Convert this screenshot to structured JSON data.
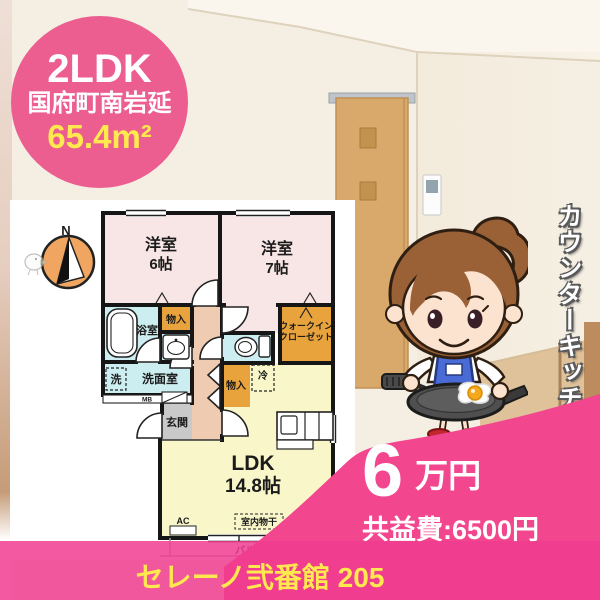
{
  "colors": {
    "badge_pink": "#ec5d90",
    "accent_pink": "#f2468e",
    "bar_pink": "#f0509b",
    "highlight_yellow": "#ffe94f",
    "plan_orange": "#e8a33d",
    "plan_blue": "#cdeef0",
    "plan_room_pink": "#f8e5e5",
    "plan_ldk_yellow": "#f9f7c9",
    "compass_orange": "#f0a561"
  },
  "badge": {
    "type": "2LDK",
    "location": "国府町南岩延",
    "area": "65.4m²"
  },
  "floorplan": {
    "compass": "N",
    "bedroom1_name": "洋室",
    "bedroom1_size": "6帖",
    "bedroom2_name": "洋室",
    "bedroom2_size": "7帖",
    "bath": "浴室",
    "closet_top": "物入",
    "closet_mid": "物入",
    "wic1": "ウォークイン",
    "wic2": "クローゼット",
    "washer": "洗",
    "washroom": "洗面室",
    "meter_box": "MB",
    "fridge": "冷",
    "entrance": "玄関",
    "ldk_name": "LDK",
    "ldk_size": "14.8帖",
    "ac": "AC",
    "indoor_hanger": "室内物干",
    "balcony": "バルコニー"
  },
  "caption_vertical": "カウンターキッチン",
  "price": {
    "amount": "6",
    "unit": "万円",
    "common_fee": "共益費:6500円"
  },
  "footer": {
    "name": "セレーノ弐番館 205"
  }
}
